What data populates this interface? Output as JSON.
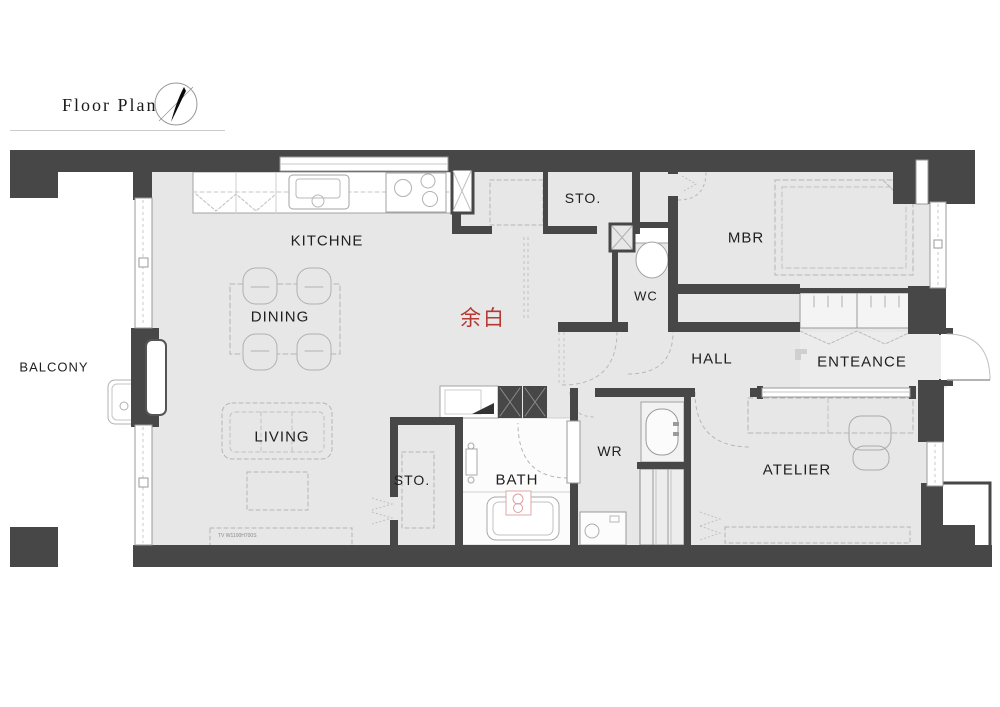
{
  "header": {
    "title": "Floor Plan"
  },
  "labels": {
    "balcony": "BALCONY",
    "kitchen": "KITCHNE",
    "dining": "DINING",
    "living": "LIVING",
    "sto_top": "STO.",
    "sto_bottom": "STO.",
    "wc": "WC",
    "mbr": "MBR",
    "hall": "HALL",
    "entrance": "ENTEANCE",
    "wr": "WR",
    "bath": "BATH",
    "atelier": "ATELIER",
    "center_note": "余白",
    "tv_note": "TV W1100H700S"
  },
  "colors": {
    "wall": "#474747",
    "floor": "#e7e7e7",
    "accent_red": "#b43a32",
    "line": "#a3a3a3"
  }
}
